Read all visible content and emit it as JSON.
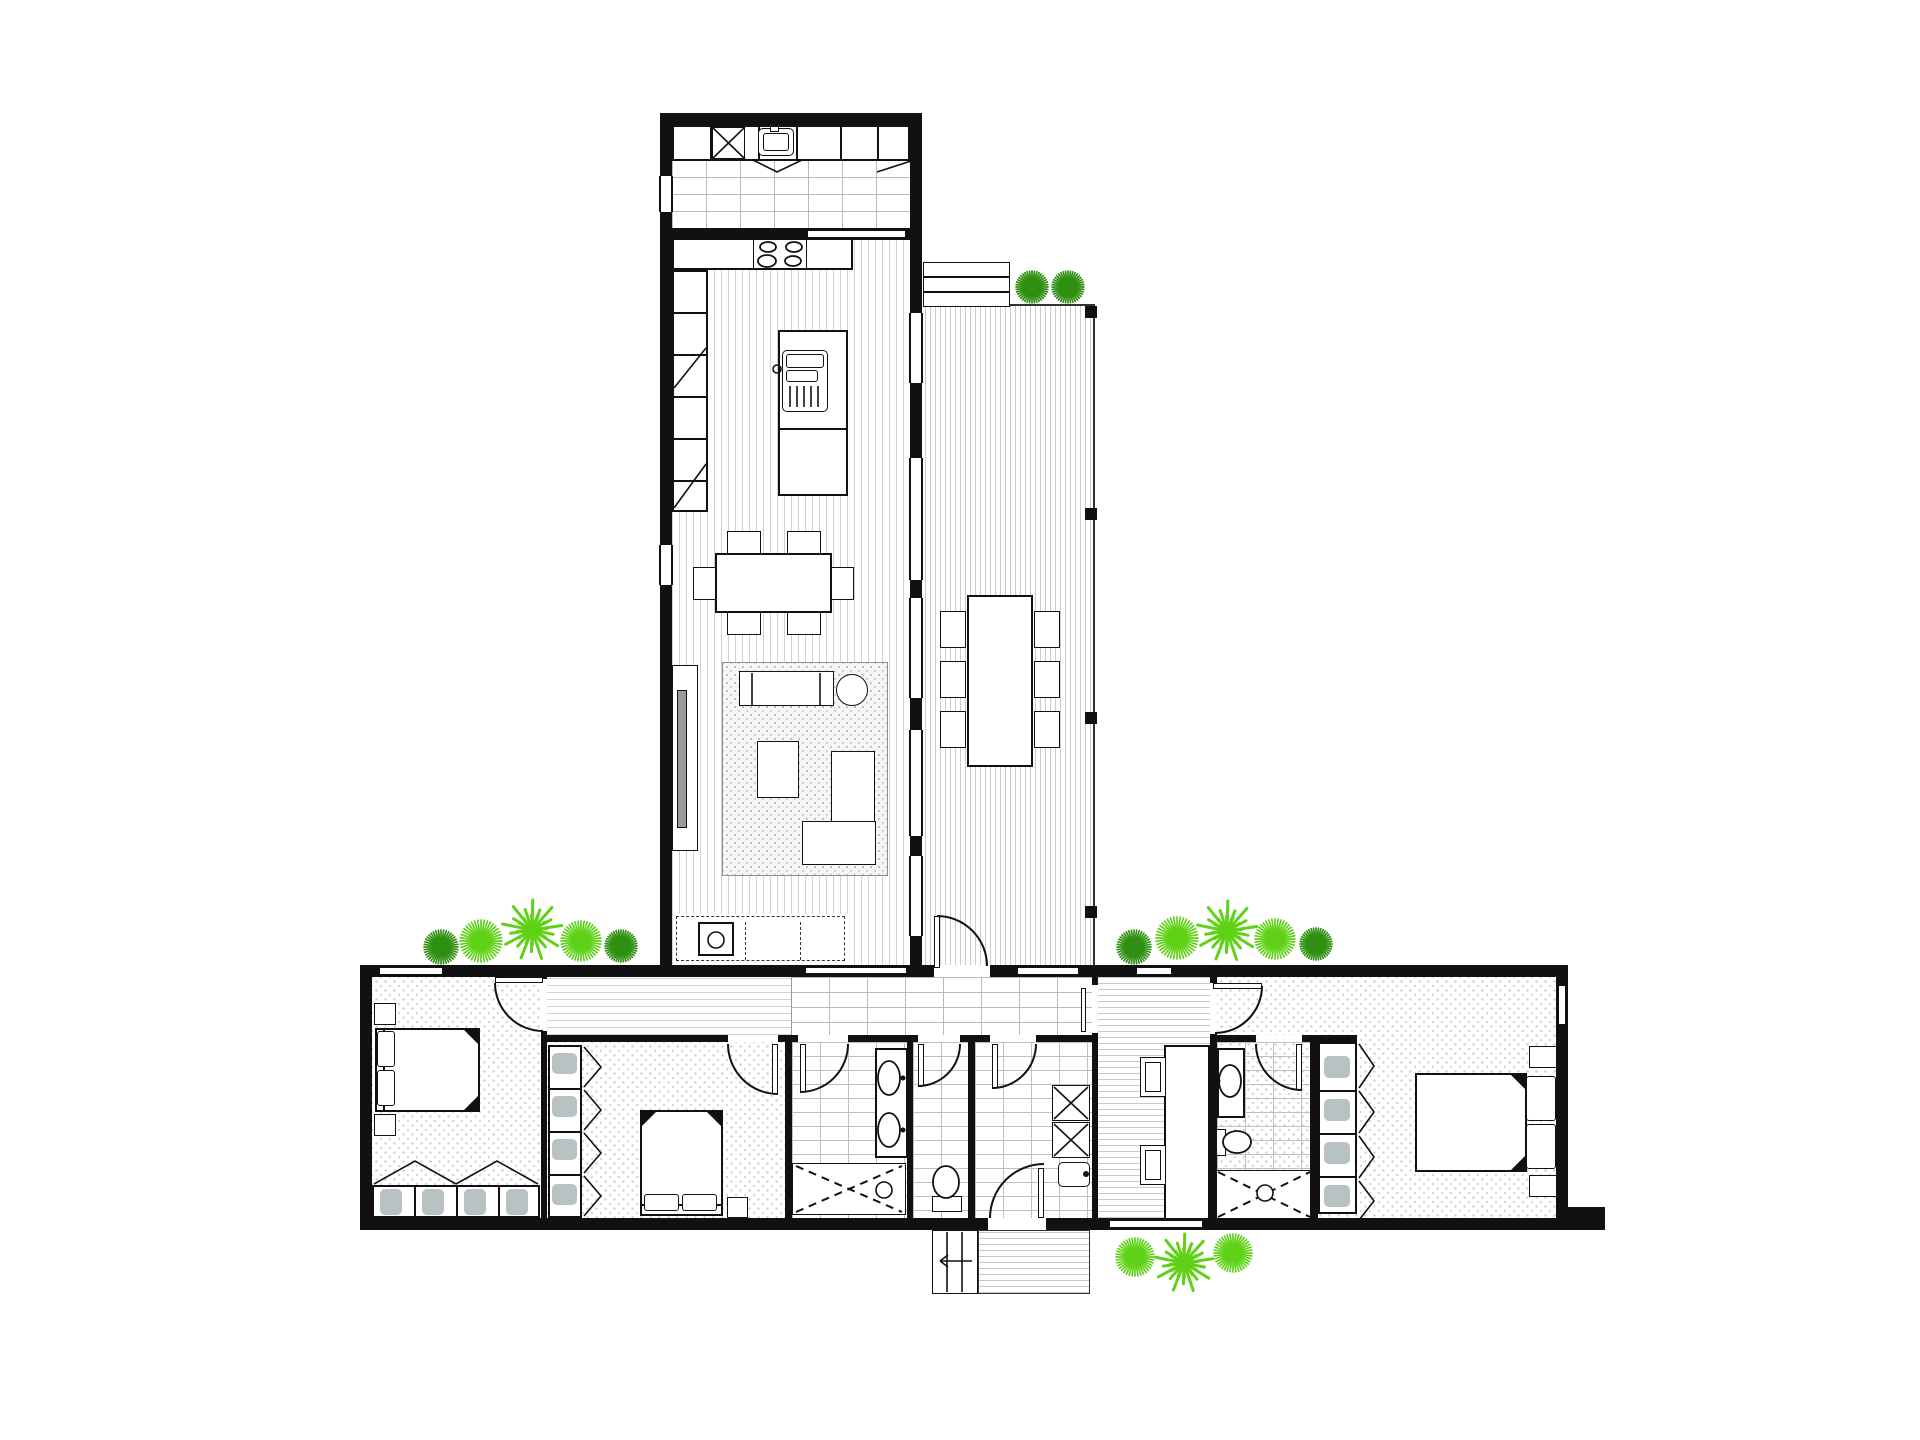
{
  "canvas": {
    "width": 1920,
    "height": 1440
  },
  "palette": {
    "wall": "#111111",
    "line": "#111111",
    "wood_stripe": "#d2d2d2",
    "deck_stripe": "#cccccc",
    "tile_line": "#b9b9b9",
    "carpet_dot": "#c7c7c7",
    "rug_bg": "#f5f5f5",
    "shelf_blob": "#b9c2c2",
    "tree_dark": "#2f8f11",
    "tree_light": "#5fd116"
  },
  "plan": {
    "type": "residential-floor-plan",
    "storeys": 1,
    "rooms": [
      {
        "id": "laundry-top",
        "floor": "tile"
      },
      {
        "id": "kitchen",
        "floor": "timber"
      },
      {
        "id": "dining",
        "floor": "timber"
      },
      {
        "id": "living",
        "floor": "timber"
      },
      {
        "id": "deck",
        "floor": "decking"
      },
      {
        "id": "hallway",
        "floor": "timber"
      },
      {
        "id": "entry-walkway",
        "floor": "tile"
      },
      {
        "id": "bedroom-1",
        "floor": "carpet"
      },
      {
        "id": "bedroom-2",
        "floor": "carpet"
      },
      {
        "id": "bathroom",
        "floor": "tile"
      },
      {
        "id": "wc",
        "floor": "tile"
      },
      {
        "id": "laundry",
        "floor": "tile"
      },
      {
        "id": "mudroom",
        "floor": "timber"
      },
      {
        "id": "ensuite",
        "floor": "tile"
      },
      {
        "id": "walk-in-robe",
        "floor": "carpet"
      },
      {
        "id": "master-bedroom",
        "floor": "carpet"
      }
    ]
  },
  "trees": [
    {
      "x": 441,
      "y": 947,
      "r": 17,
      "kind": "burst",
      "color": "dark"
    },
    {
      "x": 481,
      "y": 941,
      "r": 21,
      "kind": "burst",
      "color": "light"
    },
    {
      "x": 532,
      "y": 930,
      "r": 30,
      "kind": "flower",
      "color": "light"
    },
    {
      "x": 581,
      "y": 941,
      "r": 20,
      "kind": "burst",
      "color": "light"
    },
    {
      "x": 621,
      "y": 946,
      "r": 16,
      "kind": "burst",
      "color": "dark"
    },
    {
      "x": 1134,
      "y": 947,
      "r": 17,
      "kind": "burst",
      "color": "dark"
    },
    {
      "x": 1177,
      "y": 938,
      "r": 21,
      "kind": "burst",
      "color": "light"
    },
    {
      "x": 1227,
      "y": 931,
      "r": 30,
      "kind": "flower",
      "color": "light"
    },
    {
      "x": 1275,
      "y": 939,
      "r": 20,
      "kind": "burst",
      "color": "light"
    },
    {
      "x": 1316,
      "y": 944,
      "r": 16,
      "kind": "burst",
      "color": "dark"
    },
    {
      "x": 1032,
      "y": 287,
      "r": 16,
      "kind": "burst",
      "color": "dark"
    },
    {
      "x": 1068,
      "y": 287,
      "r": 16,
      "kind": "burst",
      "color": "dark"
    },
    {
      "x": 1135,
      "y": 1257,
      "r": 19,
      "kind": "burst",
      "color": "light"
    },
    {
      "x": 1184,
      "y": 1263,
      "r": 29,
      "kind": "flower",
      "color": "light"
    },
    {
      "x": 1233,
      "y": 1253,
      "r": 19,
      "kind": "burst",
      "color": "light"
    }
  ],
  "overlay": {
    "arcs": [
      {
        "name": "deck-door-arc",
        "d": "M 937 916 A 50 50 0 0 1 987 966"
      },
      {
        "name": "bed1-door-arc",
        "d": "M 495 983 A 48 48 0 0 0 543 1031"
      },
      {
        "name": "bed2-door-arc",
        "d": "M 728 1044 A 50 50 0 0 0 778 1094"
      },
      {
        "name": "bath-door-arc",
        "d": "M 848 1044 A 48 48 0 0 1 800 1092"
      },
      {
        "name": "wc-door-arc",
        "d": "M 960 1044 A 42 42 0 0 1 918 1086"
      },
      {
        "name": "laundry-door-arc",
        "d": "M 1036 1044 A 44 44 0 0 1 992 1088"
      },
      {
        "name": "rear-door-arc",
        "d": "M 990 1218 A 54 54 0 0 1 1044 1164"
      },
      {
        "name": "master-door-arc",
        "d": "M 1262 986 A 47 47 0 0 1 1215 1033"
      },
      {
        "name": "ensuite-door-arc",
        "d": "M 1256 1044 A 46 46 0 0 0 1302 1090"
      }
    ],
    "dashed": [
      {
        "name": "bath-shower-x",
        "d": "M 796 1166 L 902 1212"
      },
      {
        "name": "bath-shower-x",
        "d": "M 796 1212 L 902 1166"
      },
      {
        "name": "ens-shower-x",
        "d": "M 1218 1172 L 1310 1217"
      },
      {
        "name": "ens-shower-x",
        "d": "M 1218 1217 L 1310 1172"
      }
    ],
    "lines": [
      {
        "name": "washer-x",
        "x1": 712,
        "y1": 127,
        "x2": 745,
        "y2": 159
      },
      {
        "name": "washer-x",
        "x1": 745,
        "y1": 127,
        "x2": 712,
        "y2": 159
      },
      {
        "name": "laundry-app-x",
        "x1": 1054,
        "y1": 1087,
        "x2": 1088,
        "y2": 1119
      },
      {
        "name": "laundry-app-x",
        "x1": 1088,
        "y1": 1087,
        "x2": 1054,
        "y2": 1119
      },
      {
        "name": "laundry-app-x",
        "x1": 1054,
        "y1": 1124,
        "x2": 1088,
        "y2": 1156
      },
      {
        "name": "laundry-app-x",
        "x1": 1088,
        "y1": 1124,
        "x2": 1054,
        "y2": 1156
      },
      {
        "name": "cabinet-fold",
        "x1": 877,
        "y1": 172,
        "x2": 911,
        "y2": 161
      },
      {
        "name": "pantry-fold",
        "x1": 674,
        "y1": 388,
        "x2": 706,
        "y2": 348
      },
      {
        "name": "pantry-fold",
        "x1": 674,
        "y1": 508,
        "x2": 706,
        "y2": 464
      },
      {
        "name": "island-grill-bar",
        "x1": 790,
        "y1": 386,
        "x2": 790,
        "y2": 407
      },
      {
        "name": "island-grill-bar",
        "x1": 797,
        "y1": 386,
        "x2": 797,
        "y2": 407
      },
      {
        "name": "island-grill-bar",
        "x1": 804,
        "y1": 386,
        "x2": 804,
        "y2": 407
      },
      {
        "name": "island-grill-bar",
        "x1": 811,
        "y1": 386,
        "x2": 811,
        "y2": 407
      },
      {
        "name": "island-grill-bar",
        "x1": 818,
        "y1": 386,
        "x2": 818,
        "y2": 407
      },
      {
        "name": "sofa-arm",
        "x1": 752,
        "y1": 673,
        "x2": 752,
        "y2": 705
      },
      {
        "name": "sofa-arm",
        "x1": 820,
        "y1": 673,
        "x2": 820,
        "y2": 705
      },
      {
        "name": "stair-tread",
        "x1": 947,
        "y1": 1232,
        "x2": 947,
        "y2": 1292
      },
      {
        "name": "stair-tread",
        "x1": 962,
        "y1": 1232,
        "x2": 962,
        "y2": 1292
      },
      {
        "name": "stair-arrow",
        "x1": 972,
        "y1": 1261,
        "x2": 940,
        "y2": 1261
      },
      {
        "name": "stair-arrow-head",
        "x1": 940,
        "y1": 1261,
        "x2": 948,
        "y2": 1255
      },
      {
        "name": "stair-arrow-head",
        "x1": 940,
        "y1": 1261,
        "x2": 948,
        "y2": 1267
      },
      {
        "name": "rose-cross",
        "x1": 878,
        "y1": 1190,
        "x2": 890,
        "y2": 1190
      },
      {
        "name": "rose-cross",
        "x1": 884,
        "y1": 1184,
        "x2": 884,
        "y2": 1196
      },
      {
        "name": "rose-cross",
        "x1": 1259,
        "y1": 1193,
        "x2": 1271,
        "y2": 1193
      },
      {
        "name": "rose-cross",
        "x1": 1265,
        "y1": 1187,
        "x2": 1265,
        "y2": 1199
      }
    ],
    "polylines": [
      {
        "name": "sink-fold",
        "pts": "753,160 777,172 802,160"
      },
      {
        "name": "robe1-fold",
        "pts": "374,1184 415,1161 456,1184"
      },
      {
        "name": "robe1-fold",
        "pts": "456,1184 497,1161 538,1184"
      },
      {
        "name": "robe2-fold",
        "pts": "584,1047 601,1067 584,1087"
      },
      {
        "name": "robe2-fold",
        "pts": "584,1090 601,1110 584,1130"
      },
      {
        "name": "robe2-fold",
        "pts": "584,1133 601,1153 584,1173"
      },
      {
        "name": "robe2-fold",
        "pts": "584,1176 601,1196 584,1216"
      },
      {
        "name": "wir-fold",
        "pts": "1359,1044 1374,1066 1359,1088"
      },
      {
        "name": "wir-fold",
        "pts": "1359,1091 1374,1112 1359,1133"
      },
      {
        "name": "wir-fold",
        "pts": "1359,1136 1374,1157 1359,1178"
      },
      {
        "name": "wir-fold",
        "pts": "1359,1181 1374,1201 1359,1220"
      }
    ],
    "ellipses": [
      {
        "name": "burner",
        "cx": 768,
        "cy": 247,
        "rx": 8,
        "ry": 5,
        "fill": "none"
      },
      {
        "name": "burner",
        "cx": 794,
        "cy": 247,
        "rx": 8,
        "ry": 5,
        "fill": "none"
      },
      {
        "name": "burner",
        "cx": 767,
        "cy": 261,
        "rx": 9,
        "ry": 6,
        "fill": "none"
      },
      {
        "name": "burner",
        "cx": 793,
        "cy": 261,
        "rx": 8,
        "ry": 5,
        "fill": "none"
      },
      {
        "name": "basin",
        "cx": 889,
        "cy": 1078,
        "rx": 11,
        "ry": 17,
        "fill": "#fff"
      },
      {
        "name": "basin",
        "cx": 889,
        "cy": 1130,
        "rx": 11,
        "ry": 17,
        "fill": "#fff"
      },
      {
        "name": "basin",
        "cx": 1230,
        "cy": 1081,
        "rx": 11,
        "ry": 16,
        "fill": "#fff"
      },
      {
        "name": "toilet-bowl",
        "cx": 946,
        "cy": 1182,
        "rx": 13,
        "ry": 16,
        "fill": "#fff"
      },
      {
        "name": "toilet-bowl",
        "cx": 1237,
        "cy": 1142,
        "rx": 14,
        "ry": 11,
        "fill": "#fff"
      }
    ],
    "circles": [
      {
        "name": "desk-sink",
        "cx": 716,
        "cy": 940,
        "r": 8,
        "fill": "none"
      },
      {
        "name": "shower-rose",
        "cx": 884,
        "cy": 1190,
        "r": 8,
        "fill": "#fff"
      },
      {
        "name": "shower-rose",
        "cx": 1265,
        "cy": 1193,
        "r": 8,
        "fill": "#fff"
      },
      {
        "name": "island-tap",
        "cx": 777,
        "cy": 369,
        "r": 4,
        "fill": "none"
      },
      {
        "name": "tub-tap",
        "cx": 1086,
        "cy": 1174,
        "r": 3,
        "fill": "#111"
      },
      {
        "name": "basin-tap",
        "cx": 903,
        "cy": 1078,
        "r": 2.5,
        "fill": "#111"
      },
      {
        "name": "basin-tap",
        "cx": 903,
        "cy": 1130,
        "r": 2.5,
        "fill": "#111"
      },
      {
        "name": "basin-tap",
        "cx": 1218,
        "cy": 1081,
        "r": 2.5,
        "fill": "#111"
      }
    ],
    "triangles": [
      {
        "name": "bed1-fold",
        "pts": "478,1030 464,1030 478,1044"
      },
      {
        "name": "bed1-fold",
        "pts": "478,1110 464,1110 478,1096"
      },
      {
        "name": "bed2-fold",
        "pts": "642,1112 656,1112 642,1126"
      },
      {
        "name": "bed2-fold",
        "pts": "721,1112 707,1112 721,1126"
      },
      {
        "name": "mbed-fold",
        "pts": "1525,1075 1511,1075 1525,1089"
      },
      {
        "name": "mbed-fold",
        "pts": "1525,1170 1511,1170 1525,1156"
      }
    ]
  }
}
